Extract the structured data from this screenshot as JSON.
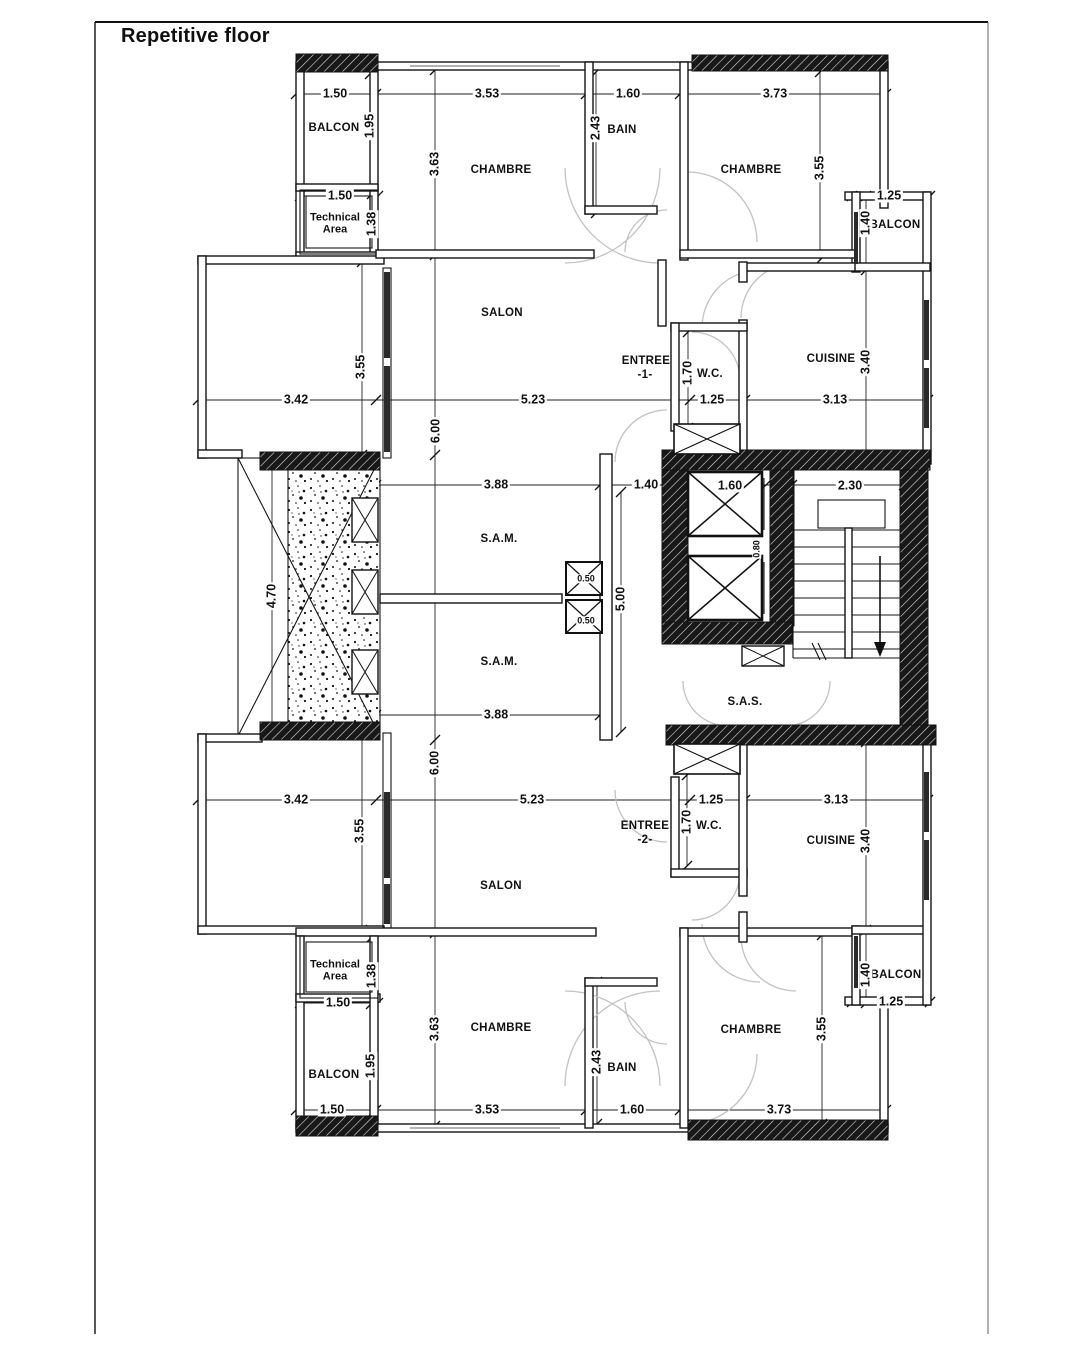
{
  "title": "Repetitive floor",
  "rooms": {
    "balcon": "BALCON",
    "technical_line1": "Technical",
    "technical_line2": "Area",
    "chambre": "CHAMBRE",
    "bain": "BAIN",
    "salon": "SALON",
    "entree": "ENTREE",
    "entree1_num": "-1-",
    "entree2_num": "-2-",
    "wc": "W.C.",
    "cuisine": "CUISINE",
    "sam": "S.A.M.",
    "sas": "S.A.S."
  },
  "dims": {
    "d0_50": "0.50",
    "d0_80": "0.80",
    "d1_25": "1.25",
    "d1_38": "1.38",
    "d1_40": "1.40",
    "d1_50": "1.50",
    "d1_60": "1.60",
    "d1_70": "1.70",
    "d1_95": "1.95",
    "d2_30": "2.30",
    "d2_43": "2.43",
    "d3_13": "3.13",
    "d3_40": "3.40",
    "d3_42": "3.42",
    "d3_53": "3.53",
    "d3_55": "3.55",
    "d3_63": "3.63",
    "d3_73": "3.73",
    "d3_88": "3.88",
    "d4_70": "4.70",
    "d5_00": "5.00",
    "d5_23": "5.23",
    "d6_00": "6.00"
  },
  "colors": {
    "wall_line": "#141414",
    "hatch_fill": "#181818",
    "door_arc": "#c2c2c2",
    "paper": "#ffffff"
  }
}
